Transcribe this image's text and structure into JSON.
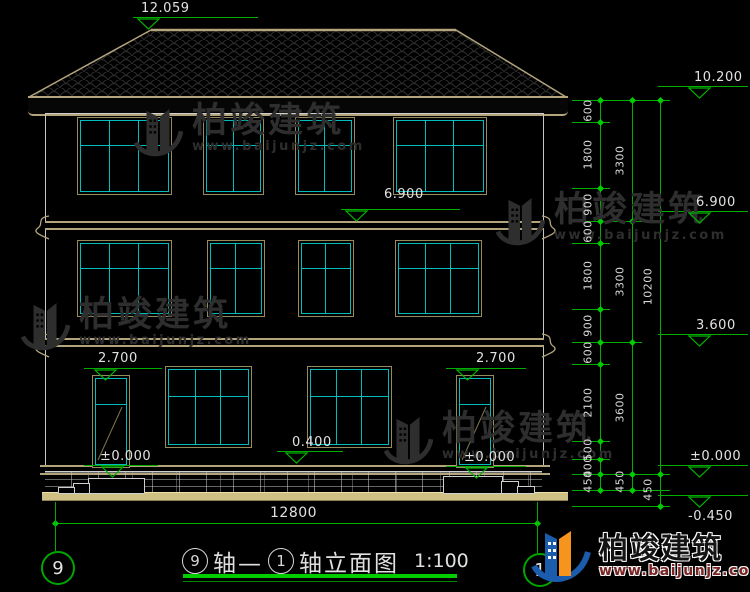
{
  "title": {
    "left_axis": "9",
    "mid": "轴—",
    "right_axis": "1",
    "name": "轴立面图",
    "scale": "1:100"
  },
  "axis_bubbles": {
    "left": "9",
    "right": "1"
  },
  "brand": {
    "name": "柏竣建筑",
    "url": "www.baijunjz.com"
  },
  "colors": {
    "dimension_green": "#00ae00",
    "frame_tan": "#958b5c",
    "window_cyan": "#00bdbd",
    "roof_outline": "#b3a47c",
    "logo_blue": "#1b5cad",
    "logo_orange": "#f7941d",
    "text_white": "#e2e2e2",
    "watermark_gray": "#2e2e2e"
  },
  "bottom_dimension": {
    "label": "12800",
    "y": 523,
    "x1": 55,
    "x2": 537,
    "label_x": 270,
    "label_y": 506,
    "ext": [
      {
        "x": 55,
        "y1": 502,
        "y2": 551
      },
      {
        "x": 537,
        "y1": 502,
        "y2": 553
      }
    ]
  },
  "right_dims": {
    "columns": [
      {
        "x": 600,
        "label_x": 588,
        "segments": [
          {
            "v": "600",
            "y1": 100,
            "y2": 122
          },
          {
            "v": "1800",
            "y1": 122,
            "y2": 188
          },
          {
            "v": "900",
            "y1": 188,
            "y2": 221
          },
          {
            "v": "600",
            "y1": 221,
            "y2": 243
          },
          {
            "v": "1800",
            "y1": 243,
            "y2": 309
          },
          {
            "v": "900",
            "y1": 309,
            "y2": 342
          },
          {
            "v": "600",
            "y1": 342,
            "y2": 364
          },
          {
            "v": "2100",
            "y1": 364,
            "y2": 441
          },
          {
            "v": "500",
            "y1": 441,
            "y2": 459
          },
          {
            "v": "400",
            "y1": 459,
            "y2": 474
          },
          {
            "v": "450",
            "y1": 474,
            "y2": 490
          }
        ]
      },
      {
        "x": 632,
        "label_x": 620,
        "segments": [
          {
            "v": "3300",
            "y1": 100,
            "y2": 221
          },
          {
            "v": "3300",
            "y1": 221,
            "y2": 342
          },
          {
            "v": "3600",
            "y1": 342,
            "y2": 474
          },
          {
            "v": "450",
            "y1": 474,
            "y2": 490
          }
        ]
      },
      {
        "x": 660,
        "label_x": 648,
        "segments": [
          {
            "v": "10200",
            "y1": 100,
            "y2": 474
          },
          {
            "v": "450",
            "y1": 474,
            "y2": 506
          }
        ]
      }
    ],
    "levels": [
      {
        "y": 100,
        "x1": 572,
        "x2": 670
      },
      {
        "y": 122,
        "x1": 572,
        "x2": 610
      },
      {
        "y": 188,
        "x1": 572,
        "x2": 610
      },
      {
        "y": 221,
        "x1": 572,
        "x2": 642
      },
      {
        "y": 243,
        "x1": 572,
        "x2": 610
      },
      {
        "y": 309,
        "x1": 572,
        "x2": 610
      },
      {
        "y": 342,
        "x1": 572,
        "x2": 642
      },
      {
        "y": 364,
        "x1": 572,
        "x2": 610
      },
      {
        "y": 441,
        "x1": 572,
        "x2": 610
      },
      {
        "y": 459,
        "x1": 572,
        "x2": 610
      },
      {
        "y": 474,
        "x1": 572,
        "x2": 670
      },
      {
        "y": 490,
        "x1": 572,
        "x2": 670
      },
      {
        "y": 506,
        "x1": 572,
        "x2": 670
      }
    ]
  },
  "elevation_markers": [
    {
      "value": "12.059",
      "tx": 141,
      "ty": 2,
      "lx": 133,
      "ly": 17,
      "lw": 125,
      "cx": 149
    },
    {
      "value": "10.200",
      "tx": 694,
      "ty": 71,
      "lx": 658,
      "ly": 86,
      "lw": 90,
      "cx": 700
    },
    {
      "value": "6.900",
      "tx": 384,
      "ty": 188,
      "lx": 341,
      "ly": 209,
      "lw": 119,
      "cx": 357
    },
    {
      "value": "6.900",
      "tx": 696,
      "ty": 196,
      "lx": 658,
      "ly": 211,
      "lw": 90,
      "cx": 700
    },
    {
      "value": "3.600",
      "tx": 696,
      "ty": 319,
      "lx": 658,
      "ly": 334,
      "lw": 90,
      "cx": 700
    },
    {
      "value": "2.700",
      "tx": 98,
      "ty": 352,
      "lx": 84,
      "ly": 368,
      "lw": 78,
      "cx": 106
    },
    {
      "value": "2.700",
      "tx": 476,
      "ty": 352,
      "lx": 446,
      "ly": 368,
      "lw": 80,
      "cx": 468
    },
    {
      "value": "0.400",
      "tx": 292,
      "ty": 436,
      "lx": 277,
      "ly": 451,
      "lw": 66,
      "cx": 297
    },
    {
      "value": "±0.000",
      "tx": 100,
      "ty": 450,
      "lx": 84,
      "ly": 465,
      "lw": 74,
      "cx": 113
    },
    {
      "value": "±0.000",
      "tx": 464,
      "ty": 451,
      "lx": 446,
      "ly": 466,
      "lw": 80,
      "cx": 477
    },
    {
      "value": "±0.000",
      "tx": 690,
      "ty": 450,
      "lx": 658,
      "ly": 465,
      "lw": 90,
      "cx": 700
    },
    {
      "value": "-0.450",
      "tx": 688,
      "ty": 510,
      "lx": 658,
      "ly": 495,
      "lw": 90,
      "cx": 700,
      "below": true
    }
  ],
  "drawing": {
    "floors": [
      {
        "name": "third-floor",
        "y": 117,
        "h": 76,
        "transom": 0.36,
        "windows": [
          {
            "x": 77,
            "w": 93,
            "cols": 3
          },
          {
            "x": 203,
            "w": 59,
            "cols": 2
          },
          {
            "x": 295,
            "w": 58,
            "cols": 2
          },
          {
            "x": 393,
            "w": 92,
            "cols": 3
          }
        ]
      },
      {
        "name": "second-floor",
        "y": 240,
        "h": 75,
        "transom": 0.36,
        "windows": [
          {
            "x": 77,
            "w": 93,
            "cols": 3
          },
          {
            "x": 207,
            "w": 56,
            "cols": 2
          },
          {
            "x": 298,
            "w": 54,
            "cols": 2
          },
          {
            "x": 395,
            "w": 85,
            "cols": 3
          }
        ]
      },
      {
        "name": "first-floor",
        "y": 366,
        "h": 80,
        "transom": 0.36,
        "windows": [
          {
            "x": 165,
            "w": 85,
            "cols": 3
          },
          {
            "x": 307,
            "w": 83,
            "cols": 3
          }
        ]
      }
    ],
    "doors": [
      {
        "x": 92,
        "w": 36,
        "y": 375,
        "h": 91
      },
      {
        "x": 456,
        "w": 36,
        "y": 375,
        "h": 91
      }
    ]
  },
  "watermarks": [
    {
      "x": 133,
      "y": 104
    },
    {
      "x": 495,
      "y": 193
    },
    {
      "x": 20,
      "y": 298
    },
    {
      "x": 383,
      "y": 412
    }
  ]
}
